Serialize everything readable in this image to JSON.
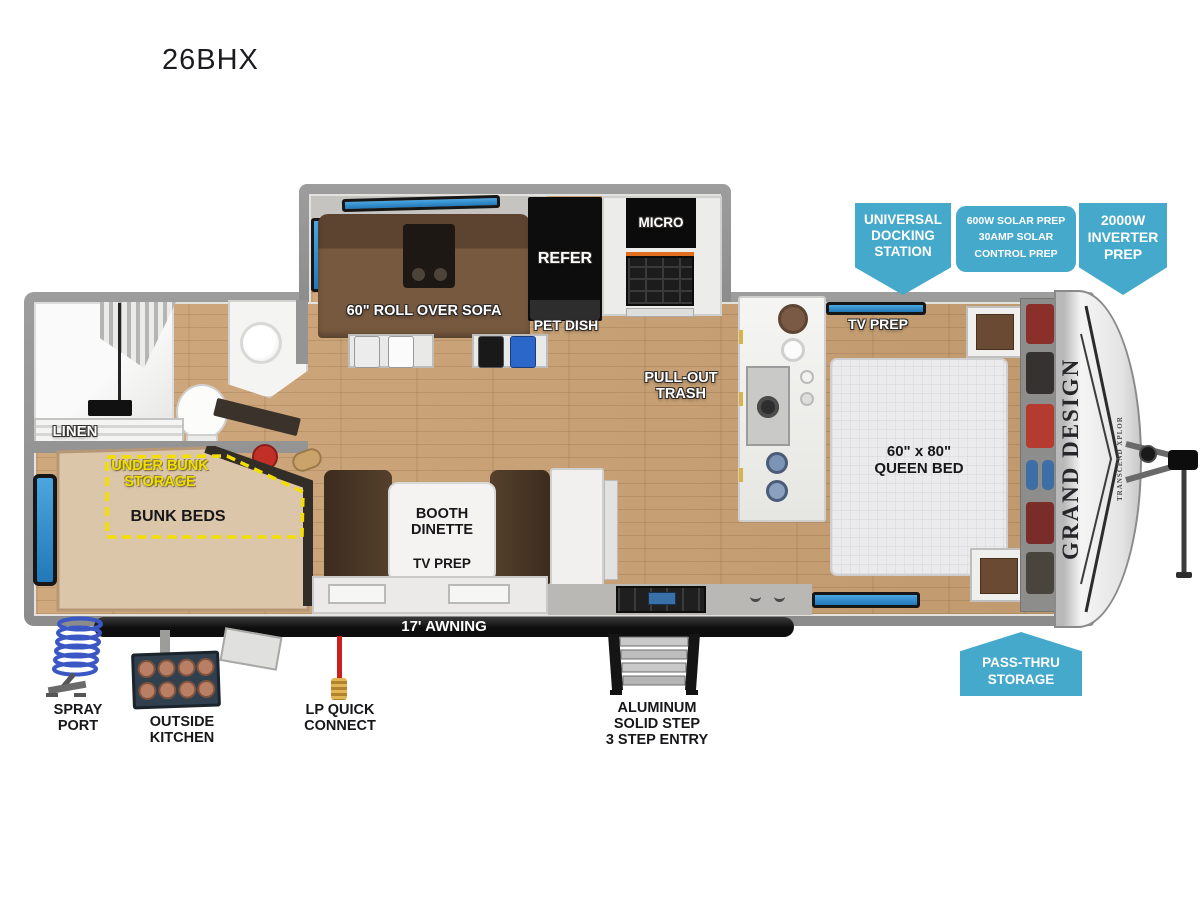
{
  "title": "26BHX",
  "callouts": {
    "universal_docking_station": "UNIVERSAL\nDOCKING\nSTATION",
    "solar_prep": "600W SOLAR PREP\n30AMP SOLAR\nCONTROL PREP",
    "inverter_prep": "2000W\nINVERTER\nPREP",
    "pass_thru_storage": "PASS-THRU\nSTORAGE"
  },
  "interior_labels": {
    "linen": "LINEN",
    "under_bunk_storage": "UNDER BUNK\nSTORAGE",
    "bunk_beds": "BUNK BEDS",
    "roll_over_sofa": "60\" ROLL OVER SOFA",
    "pet_dish": "PET DISH",
    "refer": "REFER",
    "micro": "MICRO",
    "pull_out_trash": "PULL-OUT\nTRASH",
    "tv_prep_bedroom": "TV PREP",
    "queen_bed": "60\" x 80\"\nQUEEN BED",
    "booth_dinette": "BOOTH\nDINETTE",
    "tv_prep_dinette": "TV PREP",
    "awning": "17' AWNING"
  },
  "exterior_labels": {
    "spray_port": "SPRAY\nPORT",
    "outside_kitchen": "OUTSIDE\nKITCHEN",
    "lp_quick_connect": "LP QUICK\nCONNECT",
    "step_entry": "ALUMINUM\nSOLID STEP\n3 STEP ENTRY"
  },
  "branding": {
    "brand": "GRAND DESIGN",
    "series": "TRANSCEND XPLOR"
  },
  "colors": {
    "callout_teal": "#45a9cc",
    "highlight_yellow": "#f2df00",
    "window_blue": "#2f8fd0",
    "wood_floor": "#c7a377",
    "wall_gray": "#949494"
  }
}
